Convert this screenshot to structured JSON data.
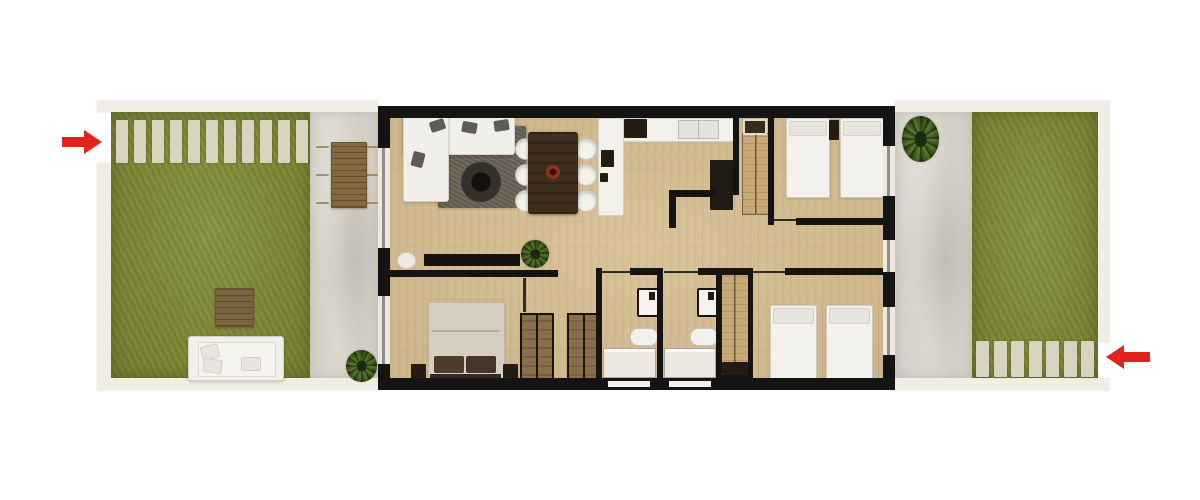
{
  "page": {
    "title": "apartment floor plan render",
    "visible_text": []
  },
  "scene": {
    "type": "top-down architectural floor plan (3D render), horizontal strip: garden - apartment - garden",
    "colors": {
      "background": "#ffffff",
      "wall": "#141414",
      "wood_floor": "#d8c095",
      "lawn": "#818c34",
      "patio": "#d3cfc6",
      "paver": "#d9d2bf",
      "plot_border": "#f0ede4",
      "rug": "#6b6256",
      "arrow": "#e2231a"
    },
    "gardens": {
      "left": {
        "label": "left garden",
        "paver_count": 11,
        "outdoor_chairs_per_side": 3,
        "items": [
          "stepping-stone path (top)",
          "outdoor dining table with 6 chairs on patio",
          "wooden coffee table on lawn",
          "white garden sofa on lawn",
          "potted plant near house"
        ]
      },
      "right": {
        "label": "right garden",
        "paver_count": 7,
        "items": [
          "stepping-stone path (bottom)",
          "potted plant on patio near house"
        ]
      }
    },
    "arrows": [
      {
        "side": "left",
        "direction": "right",
        "meaning": "entrance indicator through garden gate"
      },
      {
        "side": "right",
        "direction": "left",
        "meaning": "entrance indicator through garden gate"
      }
    ],
    "rooms": [
      {
        "name": "living-dining-room",
        "furniture": [
          "white corner sofa",
          "dark rug",
          "round black coffee table",
          "dark wood dining table",
          "6 white dining chairs",
          "tv console",
          "potted plant"
        ]
      },
      {
        "name": "kitchen",
        "furniture": [
          "top counter",
          "cooktop",
          "double sink",
          "peninsula counter with coffee maker",
          "tall dark cabinet"
        ]
      },
      {
        "name": "entry-hall",
        "furniture": [
          "doormat",
          "built-in wardrobe"
        ]
      },
      {
        "name": "bedroom-top-right",
        "furniture": [
          "single bed",
          "single bed",
          "dark nightstand"
        ]
      },
      {
        "name": "master-bedroom",
        "furniture": [
          "double bed with dark pillows",
          "nightstand left",
          "nightstand right"
        ]
      },
      {
        "name": "hallway",
        "furniture": []
      },
      {
        "name": "closet-nook",
        "furniture": [
          "wardrobe",
          "wardrobe"
        ]
      },
      {
        "name": "bathroom-1",
        "furniture": [
          "toilet",
          "washbasin",
          "shower"
        ]
      },
      {
        "name": "bathroom-2",
        "furniture": [
          "toilet",
          "washbasin",
          "shower"
        ]
      },
      {
        "name": "bedroom-bottom-right",
        "furniture": [
          "single bed",
          "single bed",
          "built-in wardrobe column"
        ]
      }
    ]
  }
}
